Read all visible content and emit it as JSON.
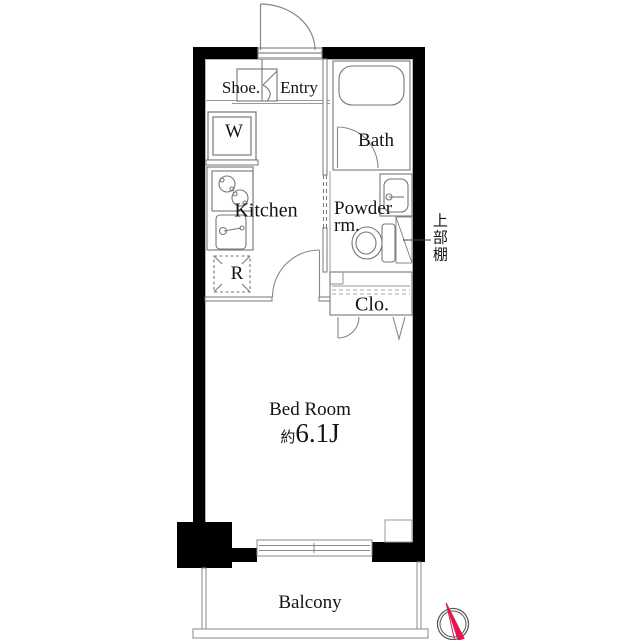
{
  "plan_title": "1K apartment floor plan",
  "labels": {
    "shoe": "Shoe.",
    "entry": "Entry",
    "washer": "W",
    "bath": "Bath",
    "kitchen": "Kitchen",
    "powder_line1": "Powder",
    "powder_line2": "rm.",
    "upper_shelf": "上部棚",
    "fridge": "R",
    "closet": "Clo.",
    "bedroom": "Bed Room",
    "bedroom_size_prefix": "約",
    "bedroom_size_value": "6.1J",
    "balcony": "Balcony"
  },
  "colors": {
    "wall": "#000000",
    "fixture_line": "#777777",
    "north_needle": "#e0164e"
  },
  "icons": {
    "compass": "north-compass"
  }
}
